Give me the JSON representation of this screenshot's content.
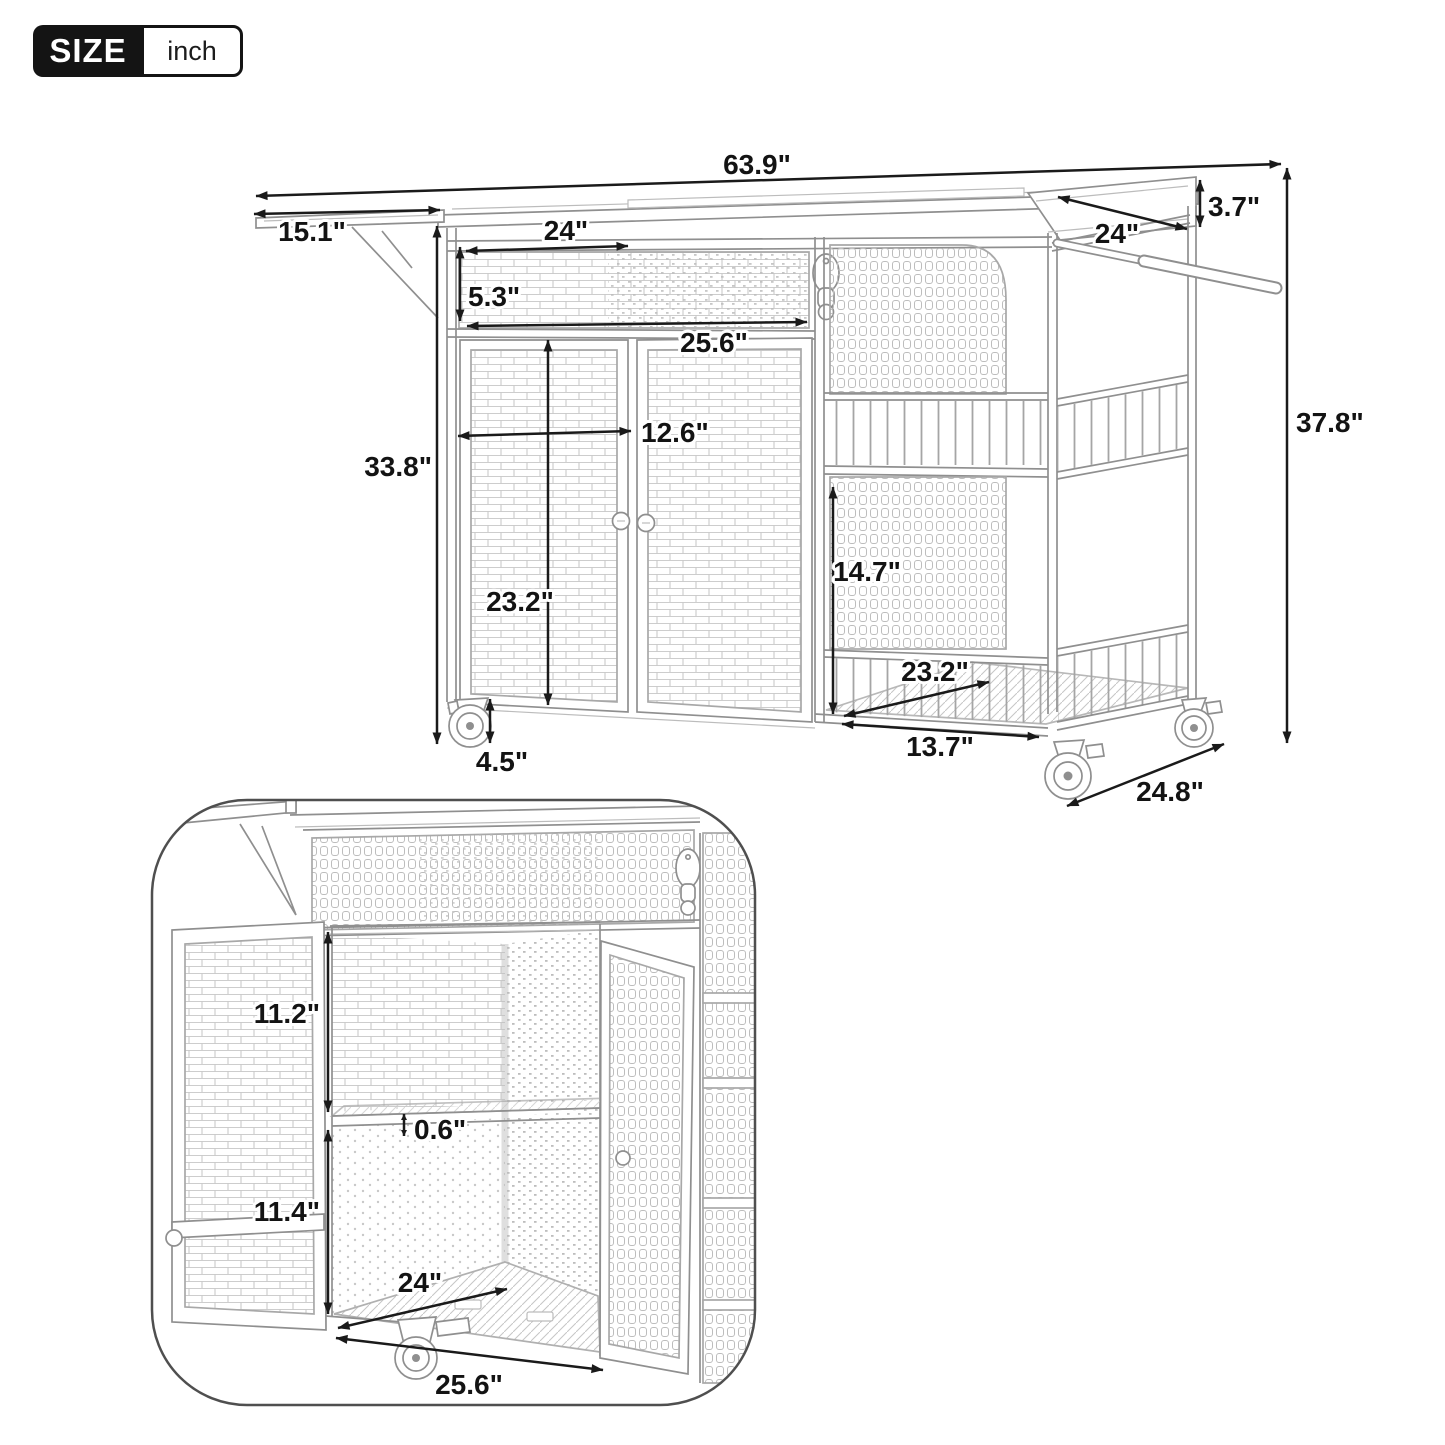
{
  "badge": {
    "label": "SIZE",
    "unit": "inch"
  },
  "main_view": {
    "dimensions": [
      {
        "id": "overall-width",
        "label": "63.9\""
      },
      {
        "id": "drop-leaf-width",
        "label": "15.1\""
      },
      {
        "id": "tabletop-depth-top",
        "label": "24\""
      },
      {
        "id": "apron-height",
        "label": "5.3\""
      },
      {
        "id": "cabinet-width",
        "label": "25.6\""
      },
      {
        "id": "cabinet-height",
        "label": "33.8\""
      },
      {
        "id": "door-width",
        "label": "12.6\""
      },
      {
        "id": "door-height",
        "label": "23.2\""
      },
      {
        "id": "right-leaf-depth",
        "label": "24\""
      },
      {
        "id": "countertop-thickness",
        "label": "3.7\""
      },
      {
        "id": "overall-height",
        "label": "37.8\""
      },
      {
        "id": "open-shelf-height",
        "label": "14.7\""
      },
      {
        "id": "base-shelf-depth",
        "label": "23.2\""
      },
      {
        "id": "base-shelf-width",
        "label": "13.7\""
      },
      {
        "id": "caster-height",
        "label": "4.5\""
      },
      {
        "id": "overall-depth",
        "label": "24.8\""
      }
    ]
  },
  "inset_view": {
    "dimensions": [
      {
        "id": "upper-compartment-height",
        "label": "11.2\""
      },
      {
        "id": "shelf-thickness",
        "label": "0.6\""
      },
      {
        "id": "lower-compartment-height",
        "label": "11.4\""
      },
      {
        "id": "interior-depth",
        "label": "24\""
      },
      {
        "id": "interior-width",
        "label": "25.6\""
      }
    ]
  }
}
